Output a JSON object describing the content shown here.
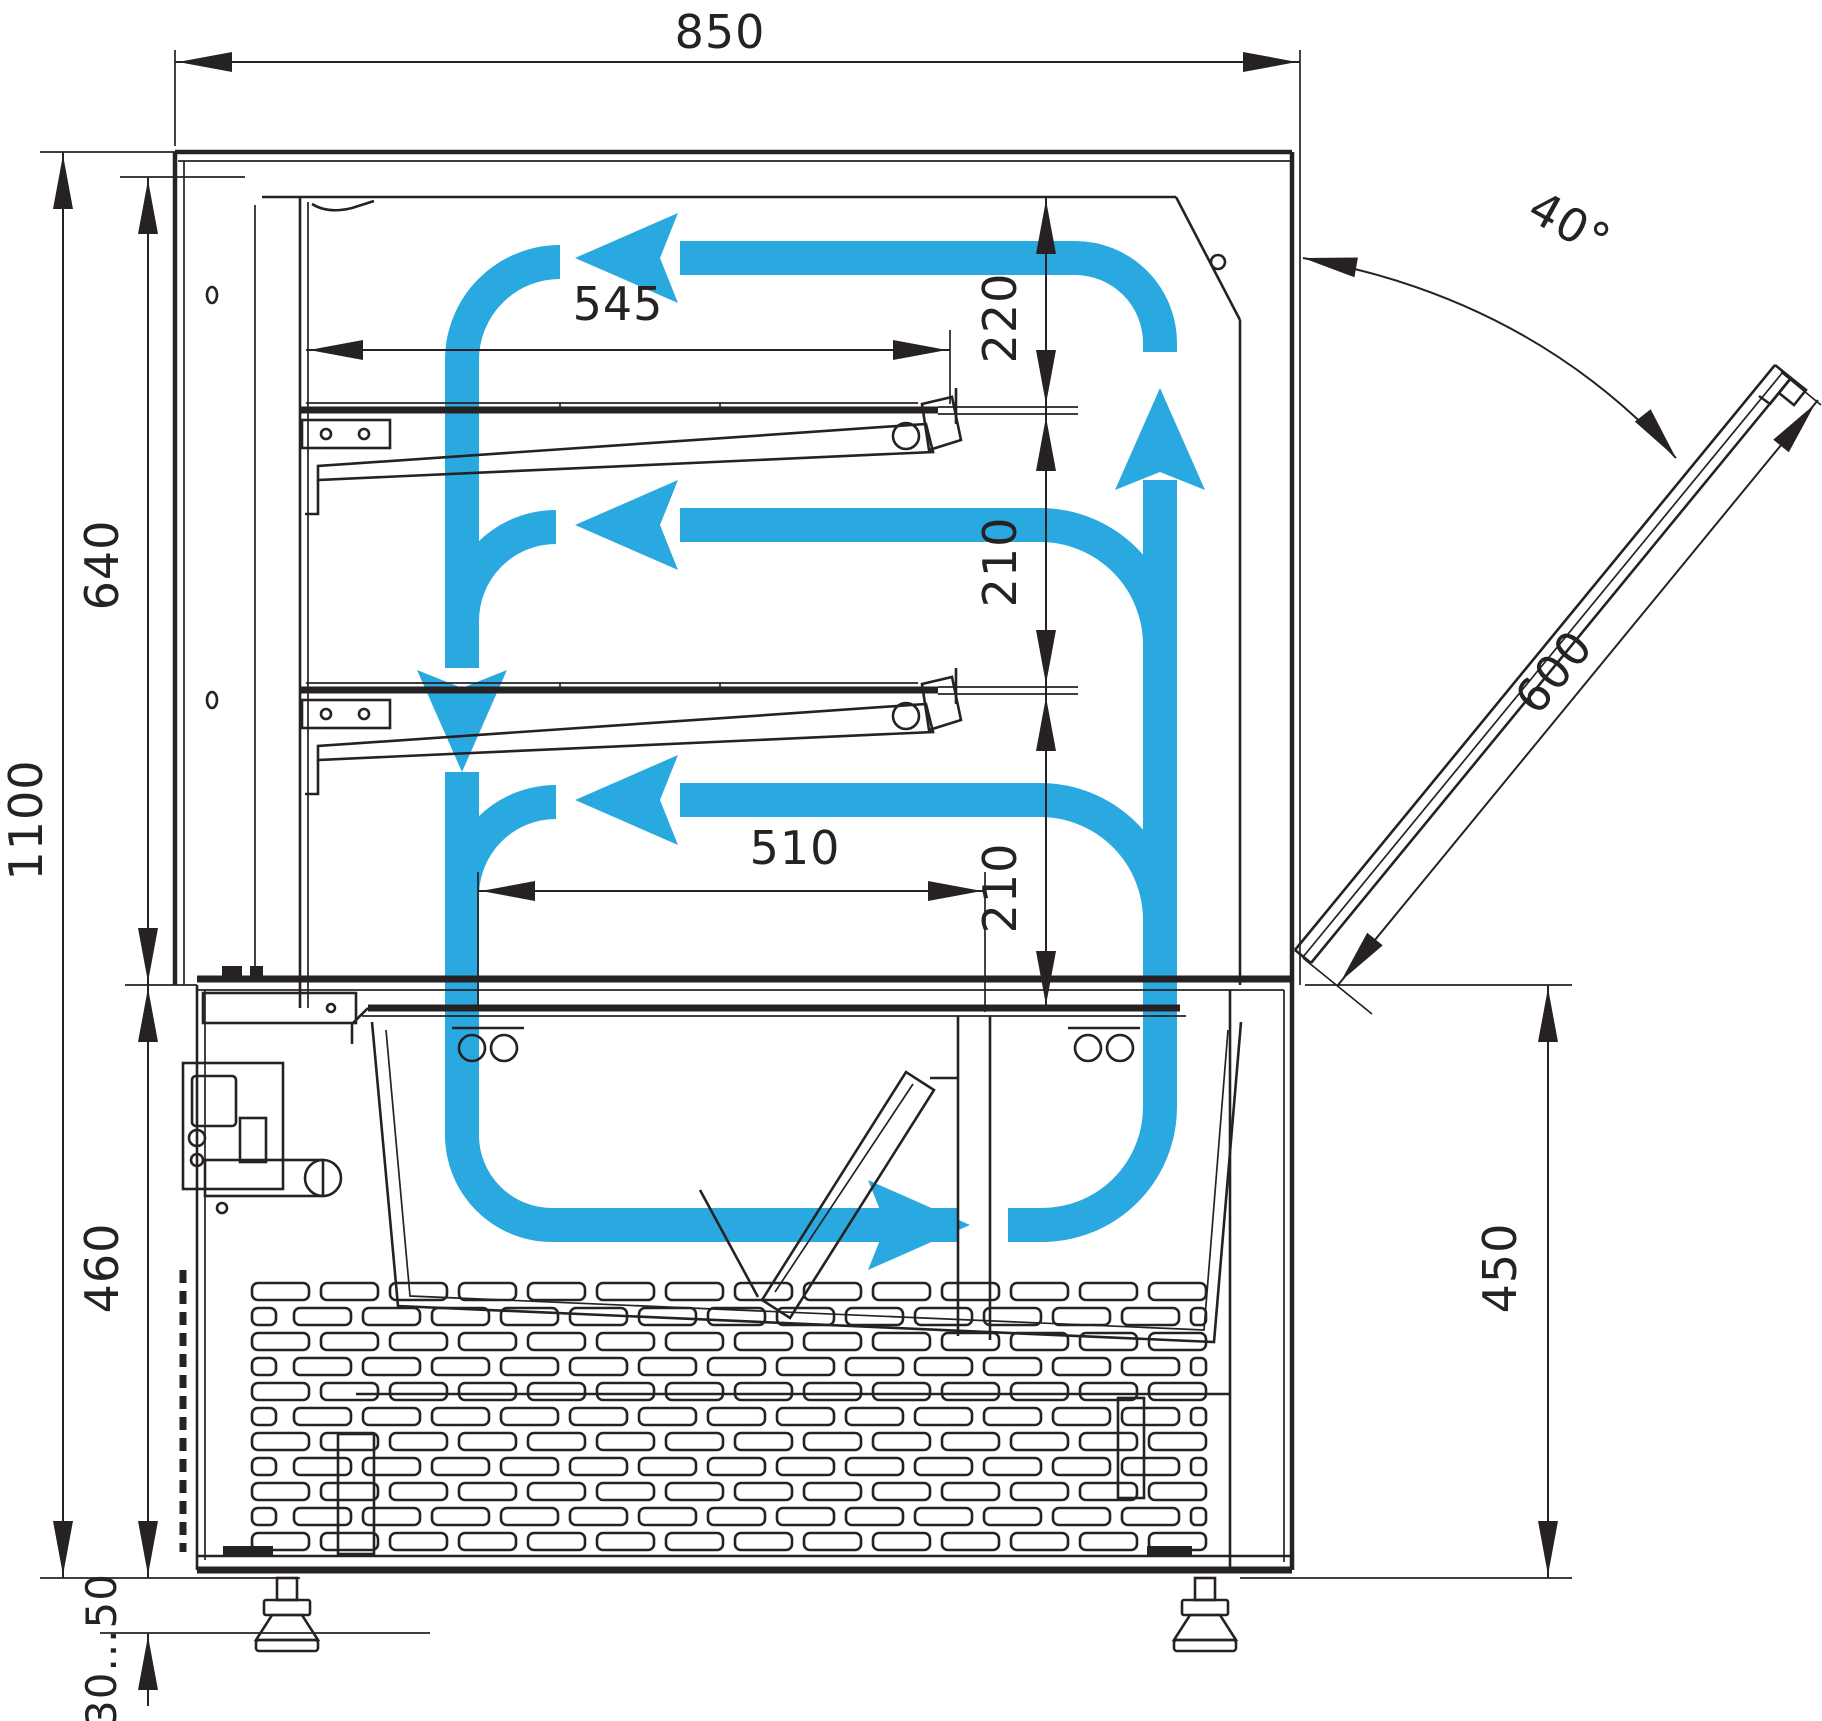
{
  "drawing": {
    "type": "technical-dimension-diagram",
    "subject": "refrigerated-display-case-cross-section-with-airflow",
    "units_shown": "mm",
    "dimensions": {
      "overall_width_top": "850",
      "overall_height": "1100",
      "display_section_height": "640",
      "base_section_height": "460",
      "adjustable_feet_range": "30...50",
      "upper_shelf_length": "545",
      "clearance_top_shelf": "220",
      "clearance_middle_shelf": "210",
      "clearance_bottom_shelf": "210",
      "deck_length": "510",
      "base_right_height": "450",
      "door_opening_angle": "40°",
      "door_length": "600"
    },
    "colors": {
      "line": "#262223",
      "airflow": "#2AA9E0",
      "background": "#FFFFFF"
    }
  }
}
